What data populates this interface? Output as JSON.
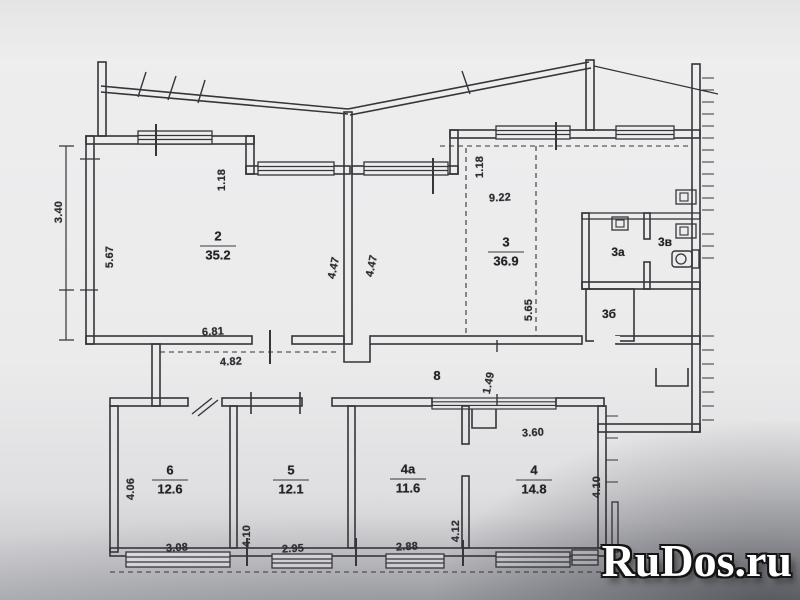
{
  "plan": {
    "rooms": [
      {
        "key": "2",
        "number": "2",
        "area": "35.2"
      },
      {
        "key": "3",
        "number": "3",
        "area": "36.9"
      },
      {
        "key": "3a",
        "number": "3а"
      },
      {
        "key": "3v",
        "number": "3в"
      },
      {
        "key": "3b",
        "number": "3б"
      },
      {
        "key": "6",
        "number": "6",
        "area": "12.6"
      },
      {
        "key": "5",
        "number": "5",
        "area": "12.1"
      },
      {
        "key": "4a",
        "number": "4а",
        "area": "11.6"
      },
      {
        "key": "4",
        "number": "4",
        "area": "14.8"
      },
      {
        "key": "8",
        "number": "8"
      }
    ],
    "dimensions": {
      "left_outer": "3.40",
      "room2_height": "5.67",
      "room2_step": "1.18",
      "room2_bottom": "6.81",
      "hall_width": "4.82",
      "wall2_length": "4.47",
      "wall3_length": "4.47",
      "room3_step": "1.18",
      "room3_top": "9.22",
      "room3_depth": "5.65",
      "hall_height": "1.49",
      "room4_top": "3.60",
      "room4_height": "4.10",
      "room6_height": "4.06",
      "room6_width": "3.08",
      "room5_height": "4.10",
      "room5_width": "2.95",
      "room4a_height": "4.12",
      "room4a_width": "2.88"
    }
  },
  "watermark": {
    "text": "RuDos.ru",
    "color": "#ffffff",
    "outline": "#141414"
  },
  "colors": {
    "paper": "#ebebec",
    "ink": "#35353a",
    "corner_shadow": "#9a9ba1"
  }
}
